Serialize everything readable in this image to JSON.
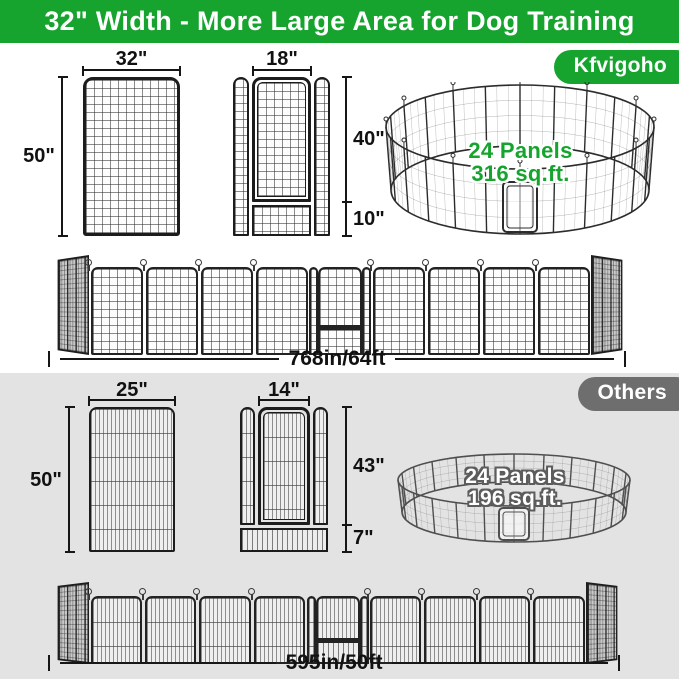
{
  "banner": {
    "title": "32\" Width - More Large Area for Dog Training"
  },
  "colors": {
    "brand_green": "#17a42e",
    "others_gray": "#6e6e6e",
    "section_gray": "#e3e3e3"
  },
  "kfvigoho": {
    "badge": "Kfvigoho",
    "panel": {
      "width_label": "32\"",
      "height_label": "50\""
    },
    "door_panel": {
      "door_width_label": "18\"",
      "door_height_label": "40\"",
      "bottom_height_label": "10\""
    },
    "pen": {
      "panels_label": "24 Panels",
      "area_label": "316 sq.ft."
    },
    "row_total_label": "768in/64ft"
  },
  "others": {
    "badge": "Others",
    "panel": {
      "width_label": "25\"",
      "height_label": "50\""
    },
    "door_panel": {
      "door_width_label": "14\"",
      "door_height_label": "43\"",
      "bottom_height_label": "7\""
    },
    "pen": {
      "panels_label": "24 Panels",
      "area_label": "196 sq.ft."
    },
    "row_total_label": "595in/50ft"
  }
}
